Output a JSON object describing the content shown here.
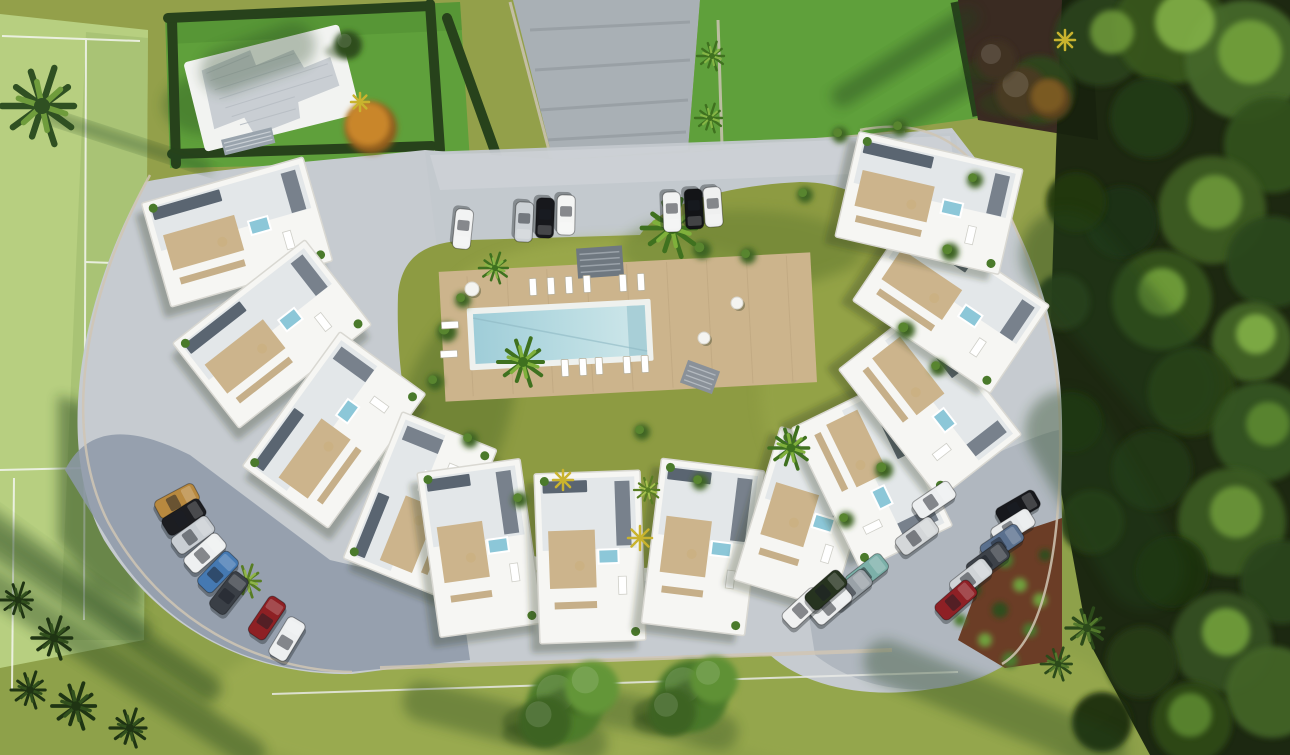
{
  "scene": {
    "description": "Aerial 3D render: crescent-shaped white apartment complex around a pool courtyard, sports field left, dense forest right, parking lots with cars"
  },
  "palette": {
    "base_grass": "#93a04a",
    "bottom_grass": "#8ea14a",
    "field_green": "#b7cf80",
    "field_dark": "#9fba6b",
    "lawn_green": "#5fa03b",
    "lawn_shadow": "#3f7a28",
    "hedge_dark": "#27421b",
    "forest_bg": "#16220e",
    "maroon_ground": "#3a2b22",
    "courtyard_grass": "#8d9b42",
    "grass_bright": "#a5b351",
    "pavement": "#c6cbd0",
    "parking_left": "#8d99a8",
    "parking_right": "#adb5bd",
    "driveway": "#a9b0b5",
    "building_white": "#f6f6f3",
    "building_edge": "#d9d8d2",
    "roof_tint": "#dfe3e6",
    "deck_tan": "#ccb48c",
    "pergola_tan": "#c3ab83",
    "panel_dark": "#5a6571",
    "jacuzzi_blue": "#8cc7d8",
    "pool_rim": "#eef1ee",
    "pool_water": "#9fcdd8",
    "pool_water_light": "#cfe7ea",
    "villa_roof": "#c9ced3",
    "soil": "#6b3d26",
    "wall_tan": "#d0c6b4",
    "fence_white": "#e9eae6",
    "line_white": "#f4f6f0",
    "car_shadow": "rgba(20,25,30,0.35)",
    "shadow_green": "#24421a",
    "bush_dark": "#3c6322",
    "bush_light": "#58852f"
  },
  "buildings": [
    {
      "x": 237,
      "y": 232,
      "w": 168,
      "h": 108,
      "rot": -16
    },
    {
      "x": 272,
      "y": 334,
      "w": 168,
      "h": 108,
      "rot": -38
    },
    {
      "x": 334,
      "y": 430,
      "w": 166,
      "h": 106,
      "rot": -54
    },
    {
      "x": 420,
      "y": 504,
      "w": 158,
      "h": 102,
      "rot": -68
    },
    {
      "x": 480,
      "y": 548,
      "w": 104,
      "h": 166,
      "rot": -8
    },
    {
      "x": 590,
      "y": 557,
      "w": 106,
      "h": 170,
      "rot": -2
    },
    {
      "x": 703,
      "y": 547,
      "w": 104,
      "h": 166,
      "rot": 7
    },
    {
      "x": 806,
      "y": 518,
      "w": 102,
      "h": 160,
      "rot": 17
    },
    {
      "x": 872,
      "y": 477,
      "w": 158,
      "h": 102,
      "rot": 64
    },
    {
      "x": 930,
      "y": 402,
      "w": 164,
      "h": 104,
      "rot": 52
    },
    {
      "x": 951,
      "y": 303,
      "w": 166,
      "h": 106,
      "rot": 34
    },
    {
      "x": 929,
      "y": 203,
      "w": 168,
      "h": 108,
      "rot": 13
    }
  ],
  "cars": {
    "top": [
      {
        "x": 463,
        "y": 229,
        "rot": 96,
        "c": "#f2f3f3"
      },
      {
        "x": 524,
        "y": 222,
        "rot": 93,
        "c": "#cdd2d6"
      },
      {
        "x": 545,
        "y": 218,
        "rot": 92,
        "c": "#17181c"
      },
      {
        "x": 566,
        "y": 215,
        "rot": 91,
        "c": "#f4f5f4"
      },
      {
        "x": 672,
        "y": 212,
        "rot": 88,
        "c": "#f2f3f3"
      },
      {
        "x": 694,
        "y": 209,
        "rot": 87,
        "c": "#131417"
      },
      {
        "x": 713,
        "y": 207,
        "rot": 86,
        "c": "#eff0f0"
      }
    ],
    "left": [
      {
        "x": 177,
        "y": 501,
        "rot": -28,
        "c": "#b8893f"
      },
      {
        "x": 184,
        "y": 517,
        "rot": -32,
        "c": "#1c1d21"
      },
      {
        "x": 193,
        "y": 535,
        "rot": -36,
        "c": "#c9ced3"
      },
      {
        "x": 205,
        "y": 553,
        "rot": -41,
        "c": "#eef0f1"
      },
      {
        "x": 218,
        "y": 572,
        "rot": -46,
        "c": "#4579b2"
      },
      {
        "x": 229,
        "y": 593,
        "rot": -52,
        "c": "#3a3f46"
      },
      {
        "x": 267,
        "y": 618,
        "rot": -56,
        "c": "#8e2024"
      },
      {
        "x": 287,
        "y": 639,
        "rot": -59,
        "c": "#edeff0"
      }
    ],
    "right": [
      {
        "x": 1018,
        "y": 508,
        "rot": -30,
        "c": "#17181c"
      },
      {
        "x": 1013,
        "y": 527,
        "rot": -32,
        "c": "#e8eaeb"
      },
      {
        "x": 1002,
        "y": 543,
        "rot": -34,
        "c": "#5a708e"
      },
      {
        "x": 988,
        "y": 561,
        "rot": -36,
        "c": "#3d4249"
      },
      {
        "x": 971,
        "y": 578,
        "rot": -38,
        "c": "#d0d4d7"
      },
      {
        "x": 956,
        "y": 600,
        "rot": -41,
        "c": "#8e2025"
      },
      {
        "x": 934,
        "y": 500,
        "rot": -34,
        "c": "#edeff0"
      },
      {
        "x": 917,
        "y": 536,
        "rot": -36,
        "c": "#d4d7d9"
      },
      {
        "x": 867,
        "y": 573,
        "rot": -38,
        "c": "#7cb0a9"
      },
      {
        "x": 851,
        "y": 589,
        "rot": -39,
        "c": "#9aa2a8"
      },
      {
        "x": 831,
        "y": 605,
        "rot": -41,
        "c": "#eceeef"
      },
      {
        "x": 803,
        "y": 608,
        "rot": -43,
        "c": "#f0f1f1"
      },
      {
        "x": 826,
        "y": 590,
        "rot": -41,
        "c": "#26331f"
      }
    ]
  },
  "forest_trees": [
    {
      "x": 1100,
      "y": 40,
      "r": 46,
      "c": "#2c421c"
    },
    {
      "x": 1170,
      "y": 28,
      "r": 56,
      "c": "#38561f"
    },
    {
      "x": 1245,
      "y": 60,
      "r": 60,
      "c": "#45682a"
    },
    {
      "x": 1272,
      "y": 145,
      "r": 48,
      "c": "#33511e"
    },
    {
      "x": 1150,
      "y": 118,
      "r": 40,
      "c": "#243a15"
    },
    {
      "x": 1212,
      "y": 210,
      "r": 54,
      "c": "#3c5c24"
    },
    {
      "x": 1272,
      "y": 262,
      "r": 46,
      "c": "#2c461a"
    },
    {
      "x": 1122,
      "y": 222,
      "r": 36,
      "c": "#1f3212"
    },
    {
      "x": 1162,
      "y": 300,
      "r": 50,
      "c": "#35531f"
    },
    {
      "x": 1252,
      "y": 342,
      "r": 40,
      "c": "#426428"
    },
    {
      "x": 1192,
      "y": 392,
      "r": 44,
      "c": "#2a4217"
    },
    {
      "x": 1262,
      "y": 432,
      "r": 50,
      "c": "#365420"
    },
    {
      "x": 1152,
      "y": 470,
      "r": 40,
      "c": "#243912"
    },
    {
      "x": 1232,
      "y": 522,
      "r": 54,
      "c": "#3a5a22"
    },
    {
      "x": 1282,
      "y": 582,
      "r": 42,
      "c": "#2c451a"
    },
    {
      "x": 1172,
      "y": 572,
      "r": 36,
      "c": "#1e3010"
    },
    {
      "x": 1222,
      "y": 642,
      "r": 50,
      "c": "#345020"
    },
    {
      "x": 1272,
      "y": 692,
      "r": 46,
      "c": "#426327"
    },
    {
      "x": 1142,
      "y": 662,
      "r": 36,
      "c": "#253a14"
    },
    {
      "x": 1192,
      "y": 722,
      "r": 40,
      "c": "#2f4819"
    },
    {
      "x": 1102,
      "y": 722,
      "r": 30,
      "c": "#1d2e0f"
    },
    {
      "x": 1076,
      "y": 202,
      "r": 30,
      "c": "#22370f"
    },
    {
      "x": 1062,
      "y": 302,
      "r": 28,
      "c": "#2a401a"
    },
    {
      "x": 1072,
      "y": 422,
      "r": 30,
      "c": "#1e330e"
    },
    {
      "x": 1092,
      "y": 522,
      "r": 32,
      "c": "#273d15"
    },
    {
      "x": 1040,
      "y": 90,
      "r": 34,
      "c": "#2e471c"
    }
  ],
  "forest_highlights": [
    {
      "x": 1185,
      "y": 22,
      "r": 30,
      "c": "#86b54a"
    },
    {
      "x": 1250,
      "y": 52,
      "r": 32,
      "c": "#76a53c"
    },
    {
      "x": 1112,
      "y": 32,
      "r": 22,
      "c": "#6f9b3a"
    },
    {
      "x": 1215,
      "y": 202,
      "r": 27,
      "c": "#6f9b3a"
    },
    {
      "x": 1162,
      "y": 292,
      "r": 24,
      "c": "#76a53c"
    },
    {
      "x": 1256,
      "y": 334,
      "r": 20,
      "c": "#86b54a"
    },
    {
      "x": 1236,
      "y": 512,
      "r": 26,
      "c": "#6f9b3a"
    },
    {
      "x": 1226,
      "y": 632,
      "r": 24,
      "c": "#76a53c"
    },
    {
      "x": 1268,
      "y": 424,
      "r": 22,
      "c": "#5e8c30"
    },
    {
      "x": 1190,
      "y": 715,
      "r": 22,
      "c": "#5e8c30"
    }
  ],
  "canopy_trees": [
    {
      "x": 565,
      "y": 705,
      "r": 38,
      "c": "#4d7c2c"
    },
    {
      "x": 592,
      "y": 688,
      "r": 27,
      "c": "#639637"
    },
    {
      "x": 545,
      "y": 722,
      "r": 26,
      "c": "#3c6322"
    },
    {
      "x": 692,
      "y": 696,
      "r": 36,
      "c": "#4a782a"
    },
    {
      "x": 714,
      "y": 680,
      "r": 24,
      "c": "#5f9135"
    },
    {
      "x": 672,
      "y": 712,
      "r": 24,
      "c": "#3c6322"
    },
    {
      "x": 348,
      "y": 45,
      "r": 14,
      "c": "#2e4d1e"
    },
    {
      "x": 1022,
      "y": 92,
      "r": 26,
      "c": "#4a3a20"
    },
    {
      "x": 996,
      "y": 60,
      "r": 20,
      "c": "#3f3122"
    }
  ],
  "orange_trees": [
    {
      "x": 368,
      "y": 124,
      "r": 26,
      "c": "#c9862c",
      "c2": "#8f5c1d"
    },
    {
      "x": 1048,
      "y": 96,
      "r": 20,
      "c": "#7a5a22",
      "c2": "#5a401a"
    }
  ],
  "palms": [
    {
      "x": 42,
      "y": 106,
      "r": 40,
      "c1": "#2f5022",
      "c2": "#6f9c3c"
    },
    {
      "x": 672,
      "y": 228,
      "r": 30,
      "c1": "#3f711f",
      "c2": "#7fb03b"
    },
    {
      "x": 523,
      "y": 362,
      "r": 25,
      "c1": "#3f711f",
      "c2": "#7fb03b"
    },
    {
      "x": 791,
      "y": 448,
      "r": 22,
      "c1": "#3f711f",
      "c2": "#7fb03b"
    },
    {
      "x": 495,
      "y": 268,
      "r": 16,
      "c1": "#3f711f",
      "c2": "#86b545"
    },
    {
      "x": 712,
      "y": 56,
      "r": 15,
      "c1": "#3f711f",
      "c2": "#86b545"
    },
    {
      "x": 710,
      "y": 118,
      "r": 15,
      "c1": "#3f711f",
      "c2": "#86b545"
    },
    {
      "x": 247,
      "y": 581,
      "r": 17,
      "c1": "#577d23",
      "c2": "#8fb548"
    },
    {
      "x": 1087,
      "y": 628,
      "r": 21,
      "c1": "#2c4a1a",
      "c2": "#53792c"
    },
    {
      "x": 1058,
      "y": 664,
      "r": 17,
      "c1": "#2c4a1a",
      "c2": "#53792c"
    },
    {
      "x": 648,
      "y": 490,
      "r": 14,
      "c1": "#577d23",
      "c2": "#a4c04e"
    },
    {
      "x": 18,
      "y": 600,
      "r": 18,
      "c1": "#1f3413",
      "c2": "#31501d"
    },
    {
      "x": 54,
      "y": 638,
      "r": 22,
      "c1": "#1f3413",
      "c2": "#31501d"
    },
    {
      "x": 30,
      "y": 690,
      "r": 19,
      "c1": "#1f3413",
      "c2": "#31501d"
    },
    {
      "x": 76,
      "y": 706,
      "r": 24,
      "c1": "#1f3413",
      "c2": "#31501d"
    },
    {
      "x": 130,
      "y": 728,
      "r": 20,
      "c1": "#1f3413",
      "c2": "#31501d"
    }
  ],
  "bushes": [
    {
      "x": 447,
      "y": 332,
      "r": 10
    },
    {
      "x": 463,
      "y": 300,
      "r": 8
    },
    {
      "x": 702,
      "y": 250,
      "r": 9
    },
    {
      "x": 748,
      "y": 256,
      "r": 8
    },
    {
      "x": 906,
      "y": 330,
      "r": 9
    },
    {
      "x": 938,
      "y": 368,
      "r": 8
    },
    {
      "x": 884,
      "y": 470,
      "r": 9
    },
    {
      "x": 846,
      "y": 520,
      "r": 8
    },
    {
      "x": 642,
      "y": 432,
      "r": 8
    },
    {
      "x": 700,
      "y": 482,
      "r": 8
    },
    {
      "x": 470,
      "y": 440,
      "r": 8
    },
    {
      "x": 520,
      "y": 500,
      "r": 8
    },
    {
      "x": 435,
      "y": 382,
      "r": 8
    },
    {
      "x": 805,
      "y": 195,
      "r": 8
    },
    {
      "x": 840,
      "y": 135,
      "r": 8
    },
    {
      "x": 900,
      "y": 128,
      "r": 8
    },
    {
      "x": 950,
      "y": 252,
      "r": 9
    },
    {
      "x": 975,
      "y": 180,
      "r": 8
    }
  ],
  "loungers": [
    {
      "x": 533,
      "y": 287,
      "rot": -3
    },
    {
      "x": 551,
      "y": 286,
      "rot": -3
    },
    {
      "x": 569,
      "y": 285,
      "rot": -3
    },
    {
      "x": 587,
      "y": 284,
      "rot": -3
    },
    {
      "x": 623,
      "y": 283,
      "rot": -3
    },
    {
      "x": 641,
      "y": 282,
      "rot": -3
    },
    {
      "x": 565,
      "y": 368,
      "rot": -3
    },
    {
      "x": 583,
      "y": 367,
      "rot": -3
    },
    {
      "x": 599,
      "y": 366,
      "rot": -3
    },
    {
      "x": 627,
      "y": 365,
      "rot": -3
    },
    {
      "x": 645,
      "y": 364,
      "rot": -3
    },
    {
      "x": 450,
      "y": 325,
      "rot": 87
    },
    {
      "x": 449,
      "y": 354,
      "rot": 87
    }
  ],
  "tables": [
    {
      "x": 472,
      "y": 289,
      "r": 7
    },
    {
      "x": 737,
      "y": 303,
      "r": 6
    },
    {
      "x": 704,
      "y": 338,
      "r": 6
    }
  ],
  "yellow_plants": [
    {
      "x": 640,
      "y": 538,
      "r": 12
    },
    {
      "x": 563,
      "y": 480,
      "r": 10
    },
    {
      "x": 360,
      "y": 102,
      "r": 9
    },
    {
      "x": 1065,
      "y": 40,
      "r": 10
    }
  ],
  "garden_tufts": [
    {
      "x": 1005,
      "y": 560,
      "r": 8,
      "c": "#4c7a2e"
    },
    {
      "x": 1020,
      "y": 585,
      "r": 7,
      "c": "#6fa03c"
    },
    {
      "x": 1000,
      "y": 610,
      "r": 8,
      "c": "#2f4d1f"
    },
    {
      "x": 1030,
      "y": 630,
      "r": 7,
      "c": "#4c7a2e"
    },
    {
      "x": 985,
      "y": 640,
      "r": 7,
      "c": "#6fa03c"
    },
    {
      "x": 1010,
      "y": 660,
      "r": 8,
      "c": "#4c7a2e"
    },
    {
      "x": 975,
      "y": 590,
      "r": 6,
      "c": "#2f4d1f"
    },
    {
      "x": 1040,
      "y": 600,
      "r": 7,
      "c": "#6fa03c"
    },
    {
      "x": 960,
      "y": 620,
      "r": 6,
      "c": "#4c7a2e"
    },
    {
      "x": 1045,
      "y": 555,
      "r": 6,
      "c": "#2f4d1f"
    }
  ],
  "shadow_streaks": [
    {
      "x": 95,
      "y": 612,
      "w": 300,
      "h": 26,
      "rot": 34,
      "o": 0.45
    },
    {
      "x": 120,
      "y": 668,
      "w": 340,
      "h": 30,
      "rot": 33,
      "o": 0.4
    },
    {
      "x": 60,
      "y": 570,
      "w": 220,
      "h": 22,
      "rot": 36,
      "o": 0.4
    },
    {
      "x": 505,
      "y": 722,
      "w": 210,
      "h": 40,
      "rot": 14,
      "o": 0.35
    },
    {
      "x": 645,
      "y": 716,
      "w": 190,
      "h": 36,
      "rot": 12,
      "o": 0.32
    },
    {
      "x": 995,
      "y": 706,
      "w": 280,
      "h": 44,
      "rot": 22,
      "o": 0.35
    },
    {
      "x": 1120,
      "y": 320,
      "w": 260,
      "h": 90,
      "rot": 50,
      "o": 0.4
    },
    {
      "x": 1105,
      "y": 500,
      "w": 240,
      "h": 80,
      "rot": 60,
      "o": 0.38
    },
    {
      "x": 905,
      "y": 57,
      "w": 170,
      "h": 22,
      "rot": -32,
      "o": 0.4
    },
    {
      "x": 935,
      "y": 102,
      "w": 150,
      "h": 20,
      "rot": -30,
      "o": 0.35
    },
    {
      "x": 128,
      "y": 142,
      "w": 175,
      "h": 10,
      "rot": 18,
      "o": 0.5
    },
    {
      "x": 258,
      "y": 58,
      "w": 120,
      "h": 46,
      "rot": -20,
      "o": 0.3
    }
  ]
}
